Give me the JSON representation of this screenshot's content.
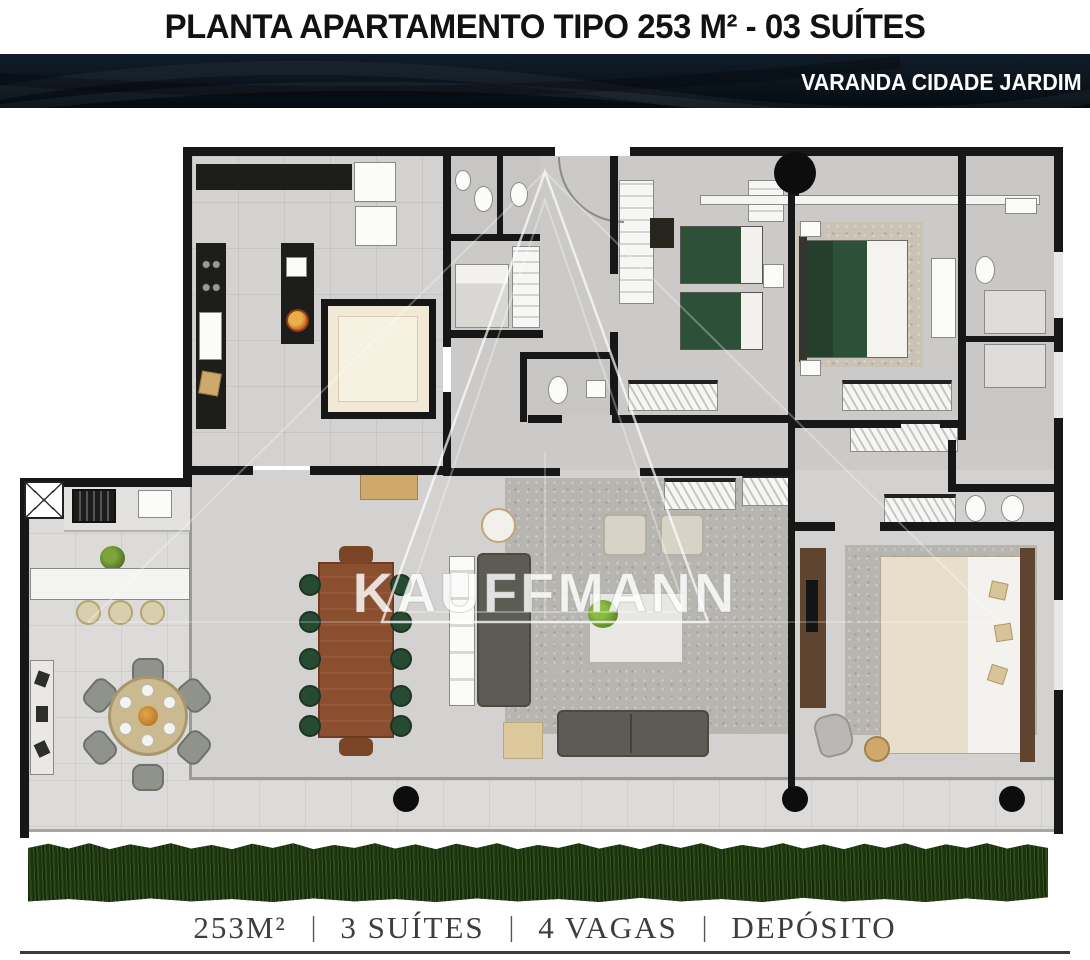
{
  "header": {
    "title": "PLANTA APARTAMENTO TIPO 253 M² - 03 SUÍTES"
  },
  "banner": {
    "label": "VARANDA CIDADE JARDIM"
  },
  "watermark": {
    "text": "KAUFFMANN"
  },
  "footer": {
    "separator": "|",
    "items": [
      "253M²",
      "3 SUÍTES",
      "4 VAGAS",
      "DEPÓSITO"
    ]
  },
  "colors": {
    "title_text": "#121212",
    "banner_bg": "#0b141d",
    "banner_text": "#fdfdfd",
    "wall": "#171717",
    "floor": "#d3d2d0",
    "floor_hall": "#cbcac8",
    "terrace": "#dcdbd9",
    "rug": "#b7b5b0",
    "rug_beige": "#cac2b4",
    "sofa": "#5c5c54",
    "armchair": "#d7d3c6",
    "bed_green": "#2d5138",
    "bed_cream": "#e8dfca",
    "wood_light": "#cfa96b",
    "wood_mid": "#8a4f2f",
    "wood_dark": "#5f4430",
    "counter": "#1d1d1b",
    "pantry": "#f1e9d6",
    "chair_green": "#274a33",
    "stool": "#d9cfad",
    "grass1": "#1d3310",
    "grass2": "#2c4b1a",
    "footer_text": "#3d3d3d",
    "watermark": "rgba(255,255,255,0.82)"
  }
}
